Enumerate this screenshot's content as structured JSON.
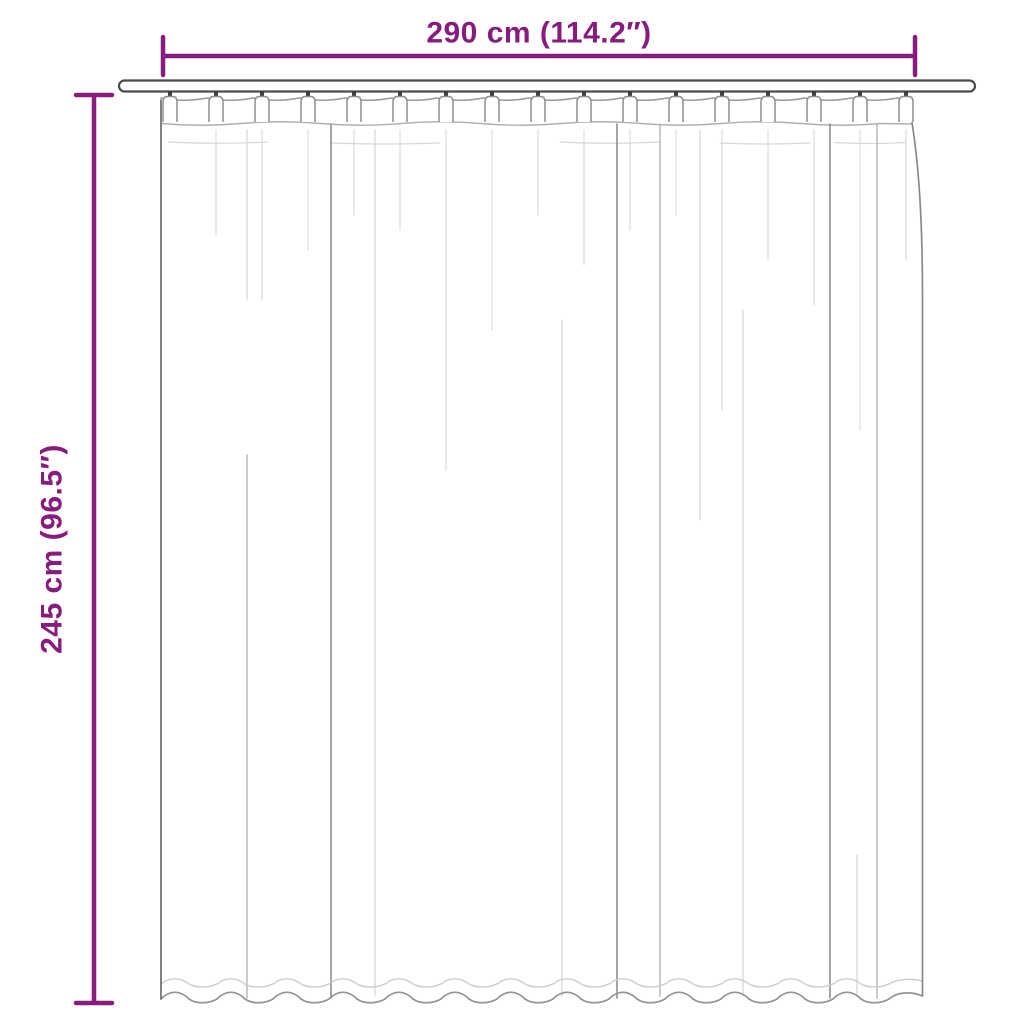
{
  "diagram": {
    "width_label": "290 cm (114.2″)",
    "height_label": "245 cm (96.5″)"
  },
  "illustration": {
    "description": "Line-art pleated curtain panel hanging on a curtain rod",
    "pleat_count": 17
  },
  "colors": {
    "accent": "#871B7E",
    "line_dark": "#4A4A4A",
    "line_medium": "#8F8F8F",
    "line_light": "#D4D4D4",
    "background": "#FFFFFF"
  }
}
